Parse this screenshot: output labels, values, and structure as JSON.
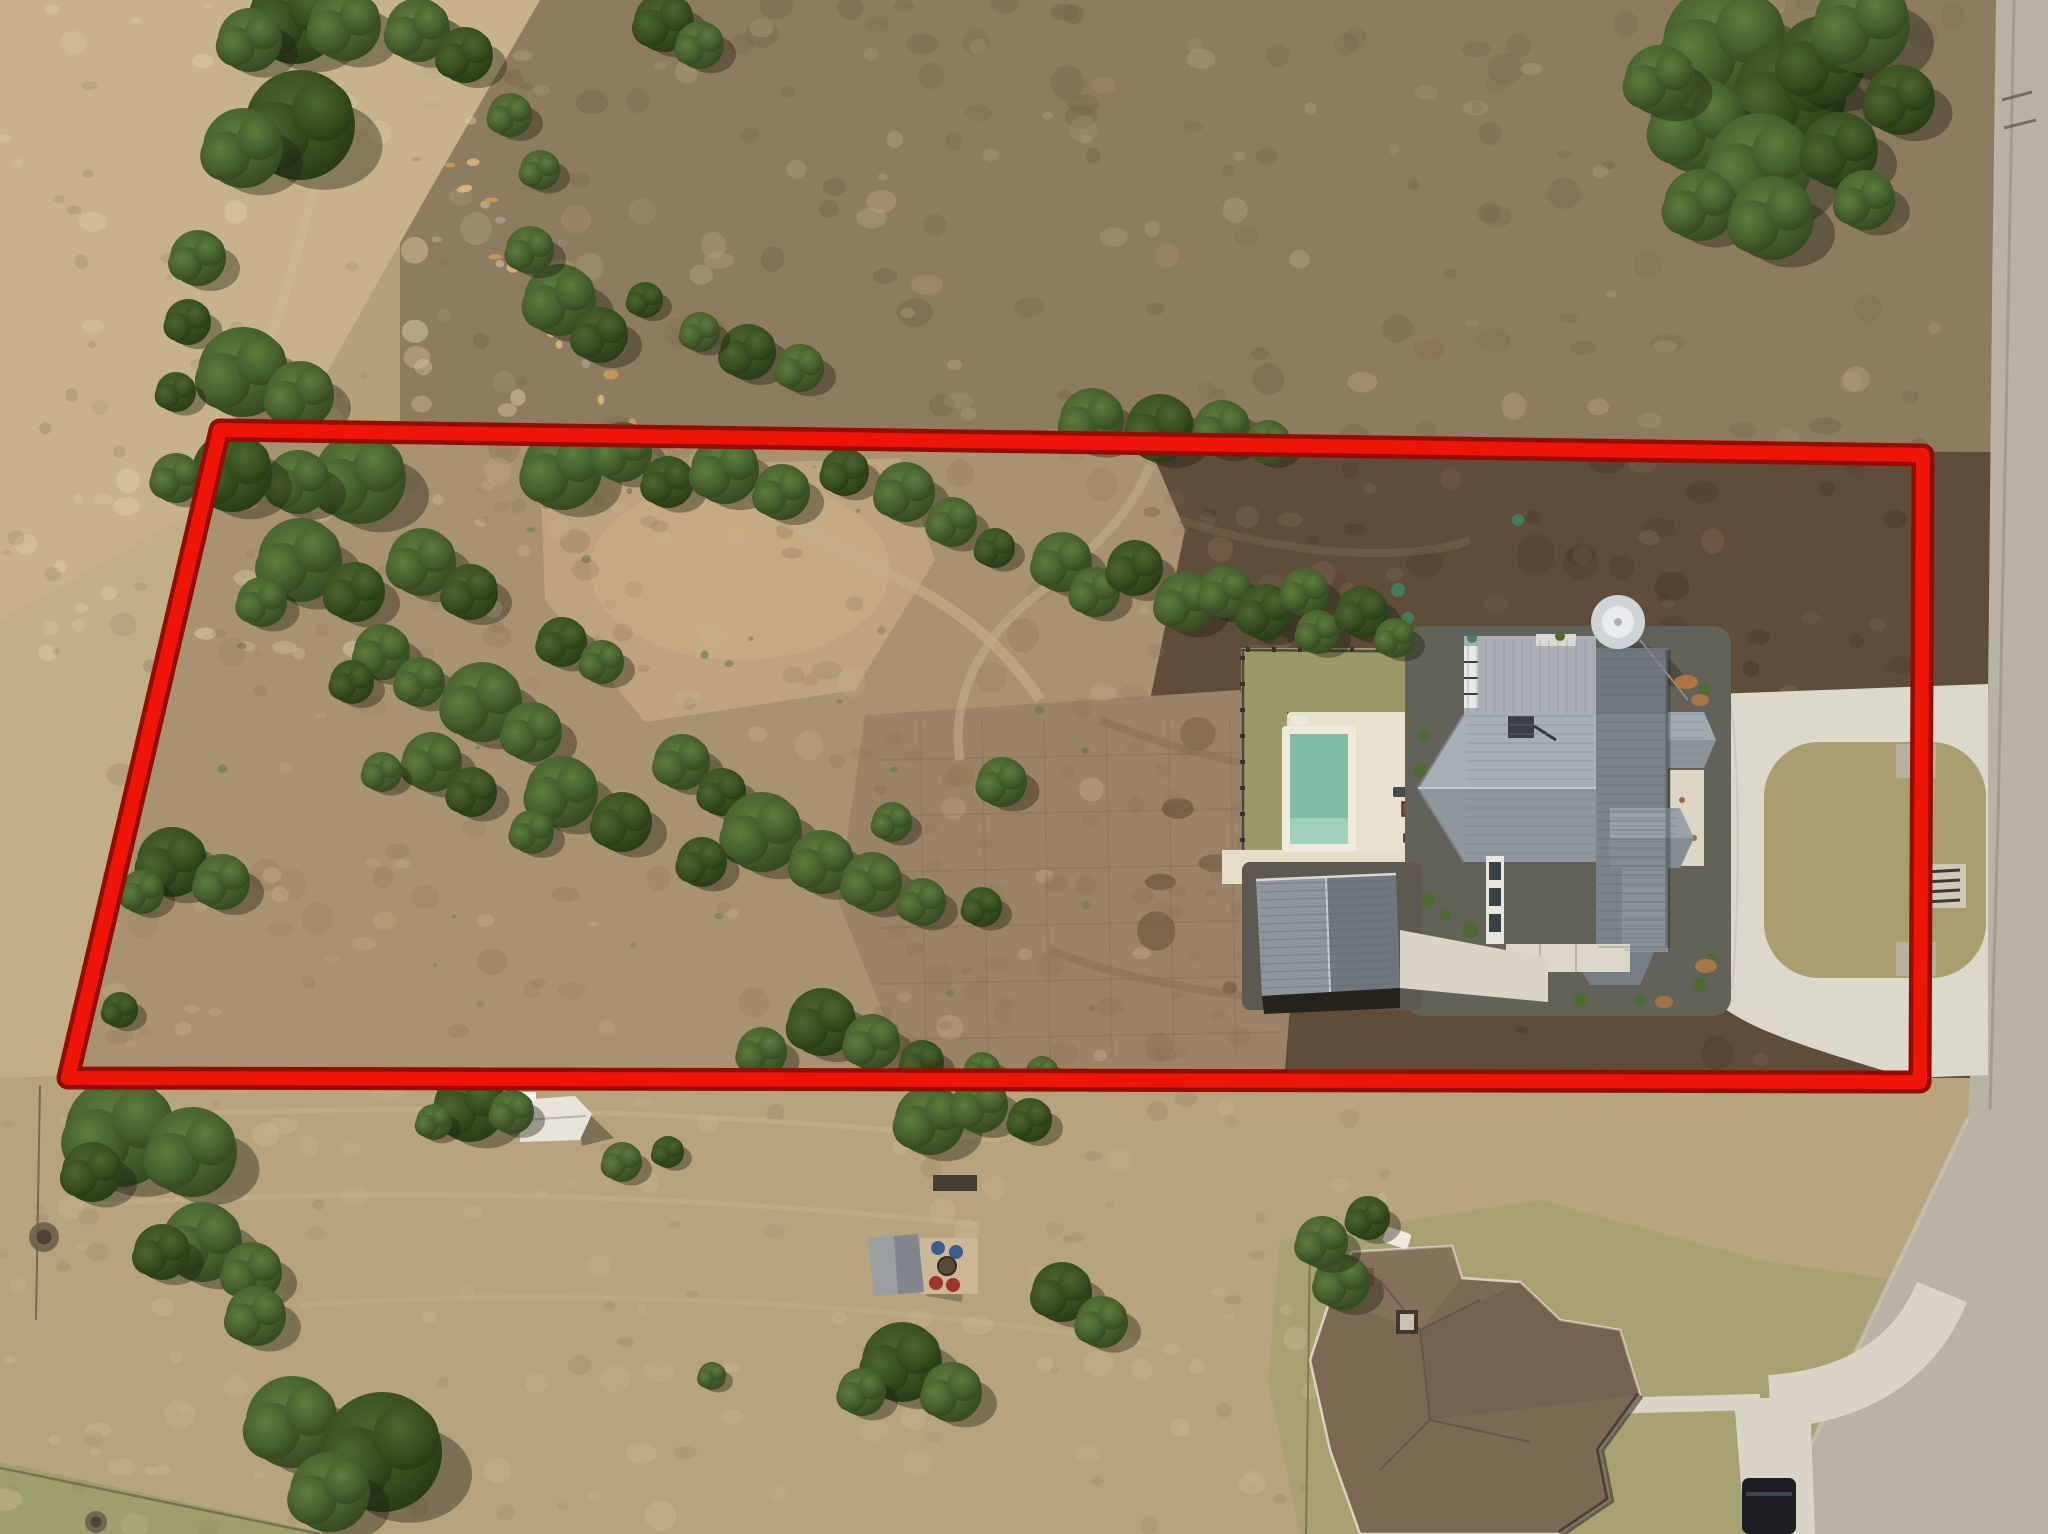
{
  "title": "Aerial drone photo of acreage lot with red property boundary outline",
  "canvas": {
    "width": 2048,
    "height": 1534
  },
  "palette": {
    "boundary_core": "#ee1408",
    "boundary_outline": "#930d05",
    "base_tan": "#b4a17c",
    "light_grass": "#c7b28c",
    "upper_scrub": "#8e7c60",
    "parcel_scrub": "#a99271",
    "cleared_dirt": "#bfa37f",
    "graded_dirt": "#9c8266",
    "dark_soil": "#5f4d3a",
    "lower_field": "#b7a47e",
    "green_lawn": "#9b9a66",
    "island_turf": "#a89e6e",
    "concrete": "#dcd8cb",
    "road": "#b9b3a5",
    "roof_light": "#a7aeb5",
    "roof_dark": "#747b83",
    "second_roof": "#7c6954",
    "pool_water": "#7fbca6",
    "cream_deck": "#e9e1cf",
    "tree_green": "#46602e",
    "tree_green_dark": "#35491f"
  },
  "boundary": {
    "label": "red outlined property boundary",
    "points": [
      [
        220,
        430
      ],
      [
        1923,
        455
      ],
      [
        1920,
        1082
      ],
      [
        68,
        1078
      ]
    ],
    "core_width": 14,
    "outline_width": 23
  },
  "objects": [
    {
      "name": "main-house",
      "desc": "modern farmhouse with gray standing-seam metal roof"
    },
    {
      "name": "water-tank",
      "desc": "round water storage tank beside house"
    },
    {
      "name": "pool",
      "desc": "rectangular pool with tanning ledge and cream deck"
    },
    {
      "name": "backyard-lawn",
      "desc": "fenced green sod yard around pool"
    },
    {
      "name": "detached-garage",
      "desc": "metal-roof detached garage/shop"
    },
    {
      "name": "circular-driveway",
      "desc": "concrete drive looping a turf island with cattle guard, two road entries"
    },
    {
      "name": "road",
      "desc": "paved road along right edge"
    },
    {
      "name": "second-house",
      "desc": "neighboring house with brown shingle hip roof, walkway, driveway and parked car"
    },
    {
      "name": "storage-shed",
      "desc": "small white shed below boundary"
    },
    {
      "name": "gazebo-firepit",
      "desc": "small gazebo with chairs and fire pit patio"
    },
    {
      "name": "cleared-dirt",
      "desc": "graded dirt building pad areas inside parcel"
    },
    {
      "name": "tree-belts",
      "desc": "scattered juniper/oak trees across parcel and fields"
    }
  ],
  "trees": {
    "belt_top_left": [
      [
        295,
        18,
        46
      ],
      [
        250,
        40,
        32
      ],
      [
        345,
        25,
        36
      ],
      [
        300,
        125,
        55
      ],
      [
        243,
        148,
        40
      ],
      [
        198,
        258,
        28
      ],
      [
        188,
        322,
        23
      ],
      [
        243,
        372,
        45
      ],
      [
        300,
        395,
        34
      ],
      [
        176,
        392,
        20
      ],
      [
        360,
        478,
        46
      ],
      [
        298,
        482,
        32
      ],
      [
        232,
        472,
        40
      ],
      [
        176,
        478,
        25
      ],
      [
        418,
        30,
        32
      ],
      [
        465,
        55,
        28
      ],
      [
        510,
        115,
        22
      ],
      [
        540,
        170,
        20
      ],
      [
        664,
        22,
        30
      ],
      [
        700,
        45,
        24
      ],
      [
        560,
        300,
        36
      ],
      [
        600,
        335,
        28
      ],
      [
        530,
        250,
        24
      ]
    ],
    "top_right_mass": [
      [
        1725,
        45,
        62
      ],
      [
        1790,
        95,
        56
      ],
      [
        1698,
        125,
        48
      ],
      [
        1760,
        165,
        52
      ],
      [
        1822,
        60,
        44
      ],
      [
        1700,
        205,
        36
      ],
      [
        1772,
        218,
        42
      ],
      [
        1840,
        150,
        38
      ],
      [
        1862,
        25,
        48
      ],
      [
        1660,
        80,
        35
      ],
      [
        1900,
        100,
        35
      ],
      [
        1865,
        200,
        30
      ]
    ],
    "top_edge": [
      [
        1092,
        420,
        32
      ],
      [
        1160,
        428,
        34
      ],
      [
        1222,
        428,
        28
      ],
      [
        1268,
        442,
        22
      ],
      [
        748,
        352,
        28
      ],
      [
        800,
        368,
        24
      ],
      [
        700,
        332,
        20
      ],
      [
        645,
        300,
        18
      ]
    ],
    "inside_upper_band": [
      [
        562,
        470,
        40
      ],
      [
        622,
        452,
        30
      ],
      [
        668,
        482,
        26
      ],
      [
        725,
        470,
        34
      ],
      [
        782,
        492,
        28
      ],
      [
        845,
        472,
        24
      ],
      [
        905,
        492,
        30
      ],
      [
        952,
        522,
        25
      ],
      [
        995,
        548,
        20
      ],
      [
        1062,
        562,
        30
      ],
      [
        1095,
        592,
        25
      ],
      [
        1135,
        568,
        28
      ],
      [
        1185,
        602,
        30
      ],
      [
        1225,
        592,
        26
      ],
      [
        1265,
        612,
        28
      ],
      [
        1305,
        592,
        24
      ],
      [
        1318,
        632,
        22
      ],
      [
        1362,
        612,
        26
      ],
      [
        1395,
        638,
        20
      ]
    ],
    "inside_left_belt": [
      [
        300,
        560,
        42
      ],
      [
        355,
        592,
        30
      ],
      [
        262,
        602,
        25
      ],
      [
        422,
        562,
        34
      ],
      [
        470,
        592,
        28
      ],
      [
        382,
        652,
        28
      ],
      [
        420,
        682,
        25
      ],
      [
        352,
        682,
        22
      ],
      [
        482,
        702,
        40
      ],
      [
        532,
        732,
        30
      ],
      [
        562,
        642,
        25
      ],
      [
        602,
        662,
        22
      ],
      [
        432,
        762,
        30
      ],
      [
        472,
        792,
        25
      ],
      [
        382,
        772,
        20
      ],
      [
        562,
        792,
        36
      ],
      [
        622,
        822,
        30
      ],
      [
        532,
        832,
        22
      ],
      [
        682,
        762,
        28
      ],
      [
        722,
        792,
        24
      ],
      [
        762,
        832,
        40
      ],
      [
        822,
        862,
        32
      ],
      [
        702,
        862,
        25
      ],
      [
        872,
        882,
        30
      ],
      [
        922,
        902,
        24
      ],
      [
        982,
        907,
        20
      ],
      [
        1002,
        782,
        25
      ],
      [
        892,
        822,
        20
      ]
    ],
    "inside_bottom": [
      [
        822,
        1022,
        34
      ],
      [
        872,
        1042,
        28
      ],
      [
        762,
        1052,
        25
      ],
      [
        922,
        1062,
        22
      ],
      [
        982,
        1070,
        18
      ],
      [
        1042,
        1072,
        16
      ]
    ],
    "left_outside": [
      [
        172,
        862,
        35
      ],
      [
        222,
        882,
        28
      ],
      [
        142,
        892,
        22
      ],
      [
        120,
        1010,
        18
      ]
    ],
    "bottom_fields": [
      [
        120,
        1132,
        55
      ],
      [
        192,
        1152,
        45
      ],
      [
        92,
        1172,
        30
      ],
      [
        202,
        1242,
        40
      ],
      [
        252,
        1272,
        30
      ],
      [
        162,
        1252,
        28
      ],
      [
        256,
        1316,
        30
      ],
      [
        292,
        1422,
        46
      ],
      [
        382,
        1452,
        60
      ],
      [
        330,
        1492,
        40
      ],
      [
        712,
        1376,
        14
      ],
      [
        470,
        1106,
        36
      ],
      [
        512,
        1112,
        22
      ],
      [
        434,
        1122,
        18
      ],
      [
        902,
        1362,
        40
      ],
      [
        952,
        1392,
        30
      ],
      [
        862,
        1392,
        24
      ],
      [
        1062,
        1292,
        30
      ],
      [
        1102,
        1322,
        26
      ],
      [
        622,
        1162,
        20
      ],
      [
        668,
        1152,
        16
      ],
      [
        1342,
        1282,
        28
      ],
      [
        1322,
        1242,
        26
      ],
      [
        1368,
        1218,
        22
      ],
      [
        930,
        1120,
        35
      ],
      [
        980,
        1105,
        28
      ],
      [
        1030,
        1120,
        22
      ]
    ]
  },
  "dead_bushes": [
    [
      44,
      1237,
      15
    ],
    [
      96,
      1522,
      11
    ]
  ],
  "green_plantings": [
    [
      1398,
      590,
      7
    ],
    [
      1408,
      618,
      6
    ],
    [
      1352,
      602,
      5
    ],
    [
      1518,
      520,
      6
    ],
    [
      1472,
      638,
      5
    ]
  ],
  "mottle_regions": [
    {
      "x": 0,
      "y": 0,
      "w": 520,
      "h": 660,
      "color": "#dccaa4",
      "op": 0.45,
      "count": 60,
      "rmin": 4,
      "rmax": 14
    },
    {
      "x": 0,
      "y": 0,
      "w": 520,
      "h": 660,
      "color": "#7e6e52",
      "op": 0.22,
      "count": 45,
      "rmin": 3,
      "rmax": 9
    },
    {
      "x": 430,
      "y": 0,
      "w": 1550,
      "h": 450,
      "color": "#6f5f47",
      "op": 0.28,
      "count": 95,
      "rmin": 5,
      "rmax": 18
    },
    {
      "x": 430,
      "y": 0,
      "w": 1550,
      "h": 450,
      "color": "#b7a584",
      "op": 0.33,
      "count": 75,
      "rmin": 5,
      "rmax": 16
    },
    {
      "x": 90,
      "y": 440,
      "w": 1080,
      "h": 620,
      "color": "#8c7657",
      "op": 0.28,
      "count": 90,
      "rmin": 5,
      "rmax": 16
    },
    {
      "x": 90,
      "y": 440,
      "w": 1080,
      "h": 620,
      "color": "#c8b48d",
      "op": 0.3,
      "count": 60,
      "rmin": 5,
      "rmax": 14
    },
    {
      "x": 220,
      "y": 450,
      "w": 880,
      "h": 580,
      "color": "#5c7038",
      "op": 0.45,
      "count": 40,
      "rmin": 2,
      "rmax": 5
    },
    {
      "x": 1150,
      "y": 460,
      "w": 770,
      "h": 600,
      "color": "#453624",
      "op": 0.33,
      "count": 75,
      "rmin": 6,
      "rmax": 20
    },
    {
      "x": 1150,
      "y": 460,
      "w": 770,
      "h": 600,
      "color": "#8a735a",
      "op": 0.28,
      "count": 55,
      "rmin": 5,
      "rmax": 14
    },
    {
      "x": 0,
      "y": 1090,
      "w": 1400,
      "h": 440,
      "color": "#cdb990",
      "op": 0.33,
      "count": 85,
      "rmin": 5,
      "rmax": 16
    },
    {
      "x": 0,
      "y": 1090,
      "w": 1400,
      "h": 440,
      "color": "#8f7c5d",
      "op": 0.22,
      "count": 60,
      "rmin": 4,
      "rmax": 12
    },
    {
      "x": 860,
      "y": 700,
      "w": 430,
      "h": 360,
      "color": "#8a6f52",
      "op": 0.3,
      "count": 42,
      "rmin": 5,
      "rmax": 14
    }
  ],
  "rock_wash": {
    "points": [
      [
        455,
        150
      ],
      [
        500,
        220
      ],
      [
        545,
        290
      ],
      [
        585,
        350
      ],
      [
        620,
        410
      ]
    ],
    "count": 26
  },
  "furniture": {
    "deck_chairs": [
      [
        1400,
        792
      ],
      [
        1422,
        814
      ],
      [
        1410,
        838
      ]
    ],
    "fire_table": [
      1409,
      809
    ],
    "gazebo_chairs_blue": [
      [
        938,
        1248
      ],
      [
        956,
        1252
      ]
    ],
    "gazebo_chairs_red": [
      [
        936,
        1283
      ],
      [
        953,
        1285
      ]
    ],
    "fire_pit": [
      947,
      1266
    ]
  }
}
